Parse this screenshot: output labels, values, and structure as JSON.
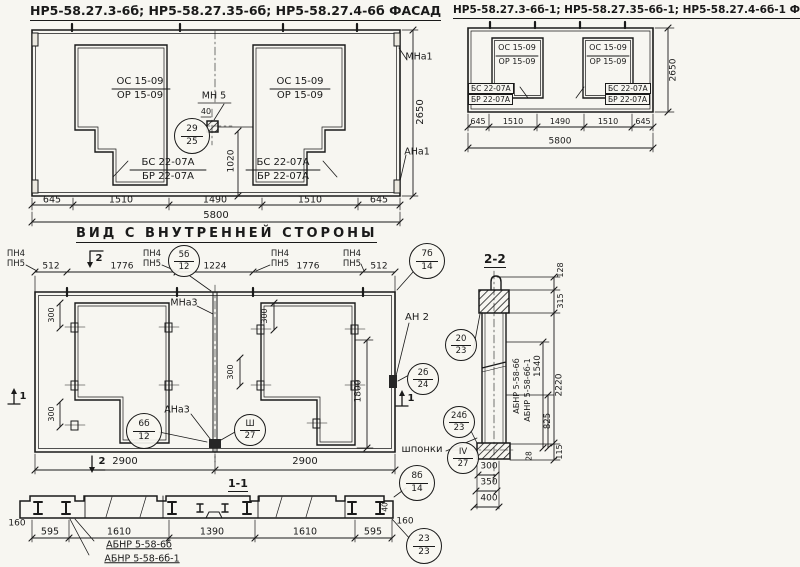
{
  "facade_main": {
    "title": "НР5-58.27.3-6б; НР5-58.27.35-6б; НР5-58.27.4-6б  ФАСАД",
    "opening_left": {
      "top": "ОС 15-09",
      "bottom": "ОР 15-09"
    },
    "opening_right": {
      "top": "ОС 15-09",
      "bottom": "ОР 15-09"
    },
    "niche_left": {
      "top": "БС 22-07А",
      "bottom": "БР 22-07А"
    },
    "niche_right": {
      "top": "БС 22-07А",
      "bottom": "БР 22-07А"
    },
    "mount_label": "МН 5",
    "dim_40": "40",
    "anchor_top_right": "МНа1",
    "anchor_bottom_right": "АНа1",
    "dim_1020": "1020",
    "dim_height": "2650",
    "dims_bottom": [
      "645",
      "1510",
      "1490",
      "1510",
      "645"
    ],
    "dim_total": "5800",
    "callout": {
      "top": "29",
      "bottom": "25"
    }
  },
  "facade_alt": {
    "title": "НР5-58.27.3-6б-1; НР5-58.27.35-6б-1; НР5-58.27.4-6б-1  ФАСАД",
    "opening_left": {
      "top": "ОС 15-09",
      "bottom": "ОР 15-09"
    },
    "opening_right": {
      "top": "ОС 15-09",
      "bottom": "ОР 15-09"
    },
    "niche_left": {
      "top": "БС 22-07А",
      "bottom": "БР 22-07А"
    },
    "niche_right": {
      "top": "БС 22-07А",
      "bottom": "БР 22-07А"
    },
    "dim_height": "2650",
    "dims_bottom": [
      "645",
      "1510",
      "1490",
      "1510",
      "645"
    ],
    "dim_total": "5800"
  },
  "inner_view": {
    "title": "ВИД С ВНУТРЕННЕЙ СТОРОНЫ",
    "dims_top": [
      "512",
      "1776",
      "1224",
      "1776",
      "512"
    ],
    "pn_pair": {
      "top": "ПН4",
      "bottom": "ПН5"
    },
    "joint_top_label": "МНа3",
    "joint_bottom_label": "АНа3",
    "anchor_label": "АН 2",
    "dim_300": "300",
    "dim_1800": "1800",
    "dims_bottom": [
      "2900",
      "2900"
    ],
    "section_marker_1": "1",
    "section_marker_2": "2",
    "callout_5b12": {
      "top": "5б",
      "bottom": "12"
    },
    "callout_7b14": {
      "top": "7б",
      "bottom": "14"
    },
    "callout_6b12": {
      "top": "6б",
      "bottom": "12"
    },
    "callout_sh27": {
      "top": "Ш",
      "bottom": "27"
    },
    "callout_2b24": {
      "top": "2б",
      "bottom": "24"
    }
  },
  "section_1_1": {
    "title": "1-1",
    "dims_bottom": [
      "595",
      "1610",
      "1390",
      "1610",
      "595"
    ],
    "dim_160_left": "160",
    "dim_160_right": "160",
    "dim_40": "40",
    "label_line1": "АБНР 5-58-6б",
    "label_line2": "АБНР 5-58-6б-1",
    "callout_8b14": {
      "top": "8б",
      "bottom": "14"
    },
    "callout_2323": {
      "top": "23",
      "bottom": "23"
    }
  },
  "section_2_2": {
    "title": "2-2",
    "dim_128": "128",
    "dim_315": "315",
    "dim_2220": "2220",
    "dim_1540": "1540",
    "dim_825": "825",
    "dim_28": "28",
    "dim_115": "115",
    "dims_foot": [
      "300",
      "350",
      "400"
    ],
    "vertical_label_1": "АБНР 5-58-6б",
    "vertical_label_2": "АБНР 5-58-6б-1",
    "keys_label": "шпонки",
    "callout_2023": {
      "top": "20",
      "bottom": "23"
    },
    "callout_24b23": {
      "top": "24б",
      "bottom": "23"
    },
    "callout_iv27": {
      "top": "IV",
      "bottom": "27"
    }
  }
}
